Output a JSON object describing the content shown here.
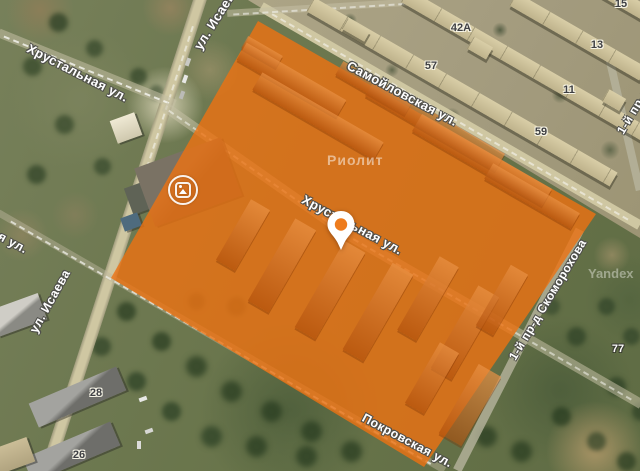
{
  "map": {
    "street_labels": [
      {
        "text": "Хрустальная ул."
      },
      {
        "text": "ул. Исаева"
      },
      {
        "text": "Самойловская ул."
      },
      {
        "text": "Хрустальная ул."
      },
      {
        "text": "ул. Исаева"
      },
      {
        "text": "1-й пр-д Скоморохова"
      },
      {
        "text": "Покровская ул."
      },
      {
        "text": "Покровская ул."
      },
      {
        "text": "1-й пр-д Скоморохова"
      }
    ],
    "house_numbers": [
      {
        "text": "15"
      },
      {
        "text": "13"
      },
      {
        "text": "42А"
      },
      {
        "text": "11"
      },
      {
        "text": "57"
      },
      {
        "text": "59"
      },
      {
        "text": "28"
      },
      {
        "text": "26"
      },
      {
        "text": "77"
      }
    ],
    "poi_label": "Риолит",
    "watermark": "Yandex",
    "colors": {
      "highlight_overlay": "#ed7211",
      "pin_center": "#ee7c1e"
    }
  }
}
